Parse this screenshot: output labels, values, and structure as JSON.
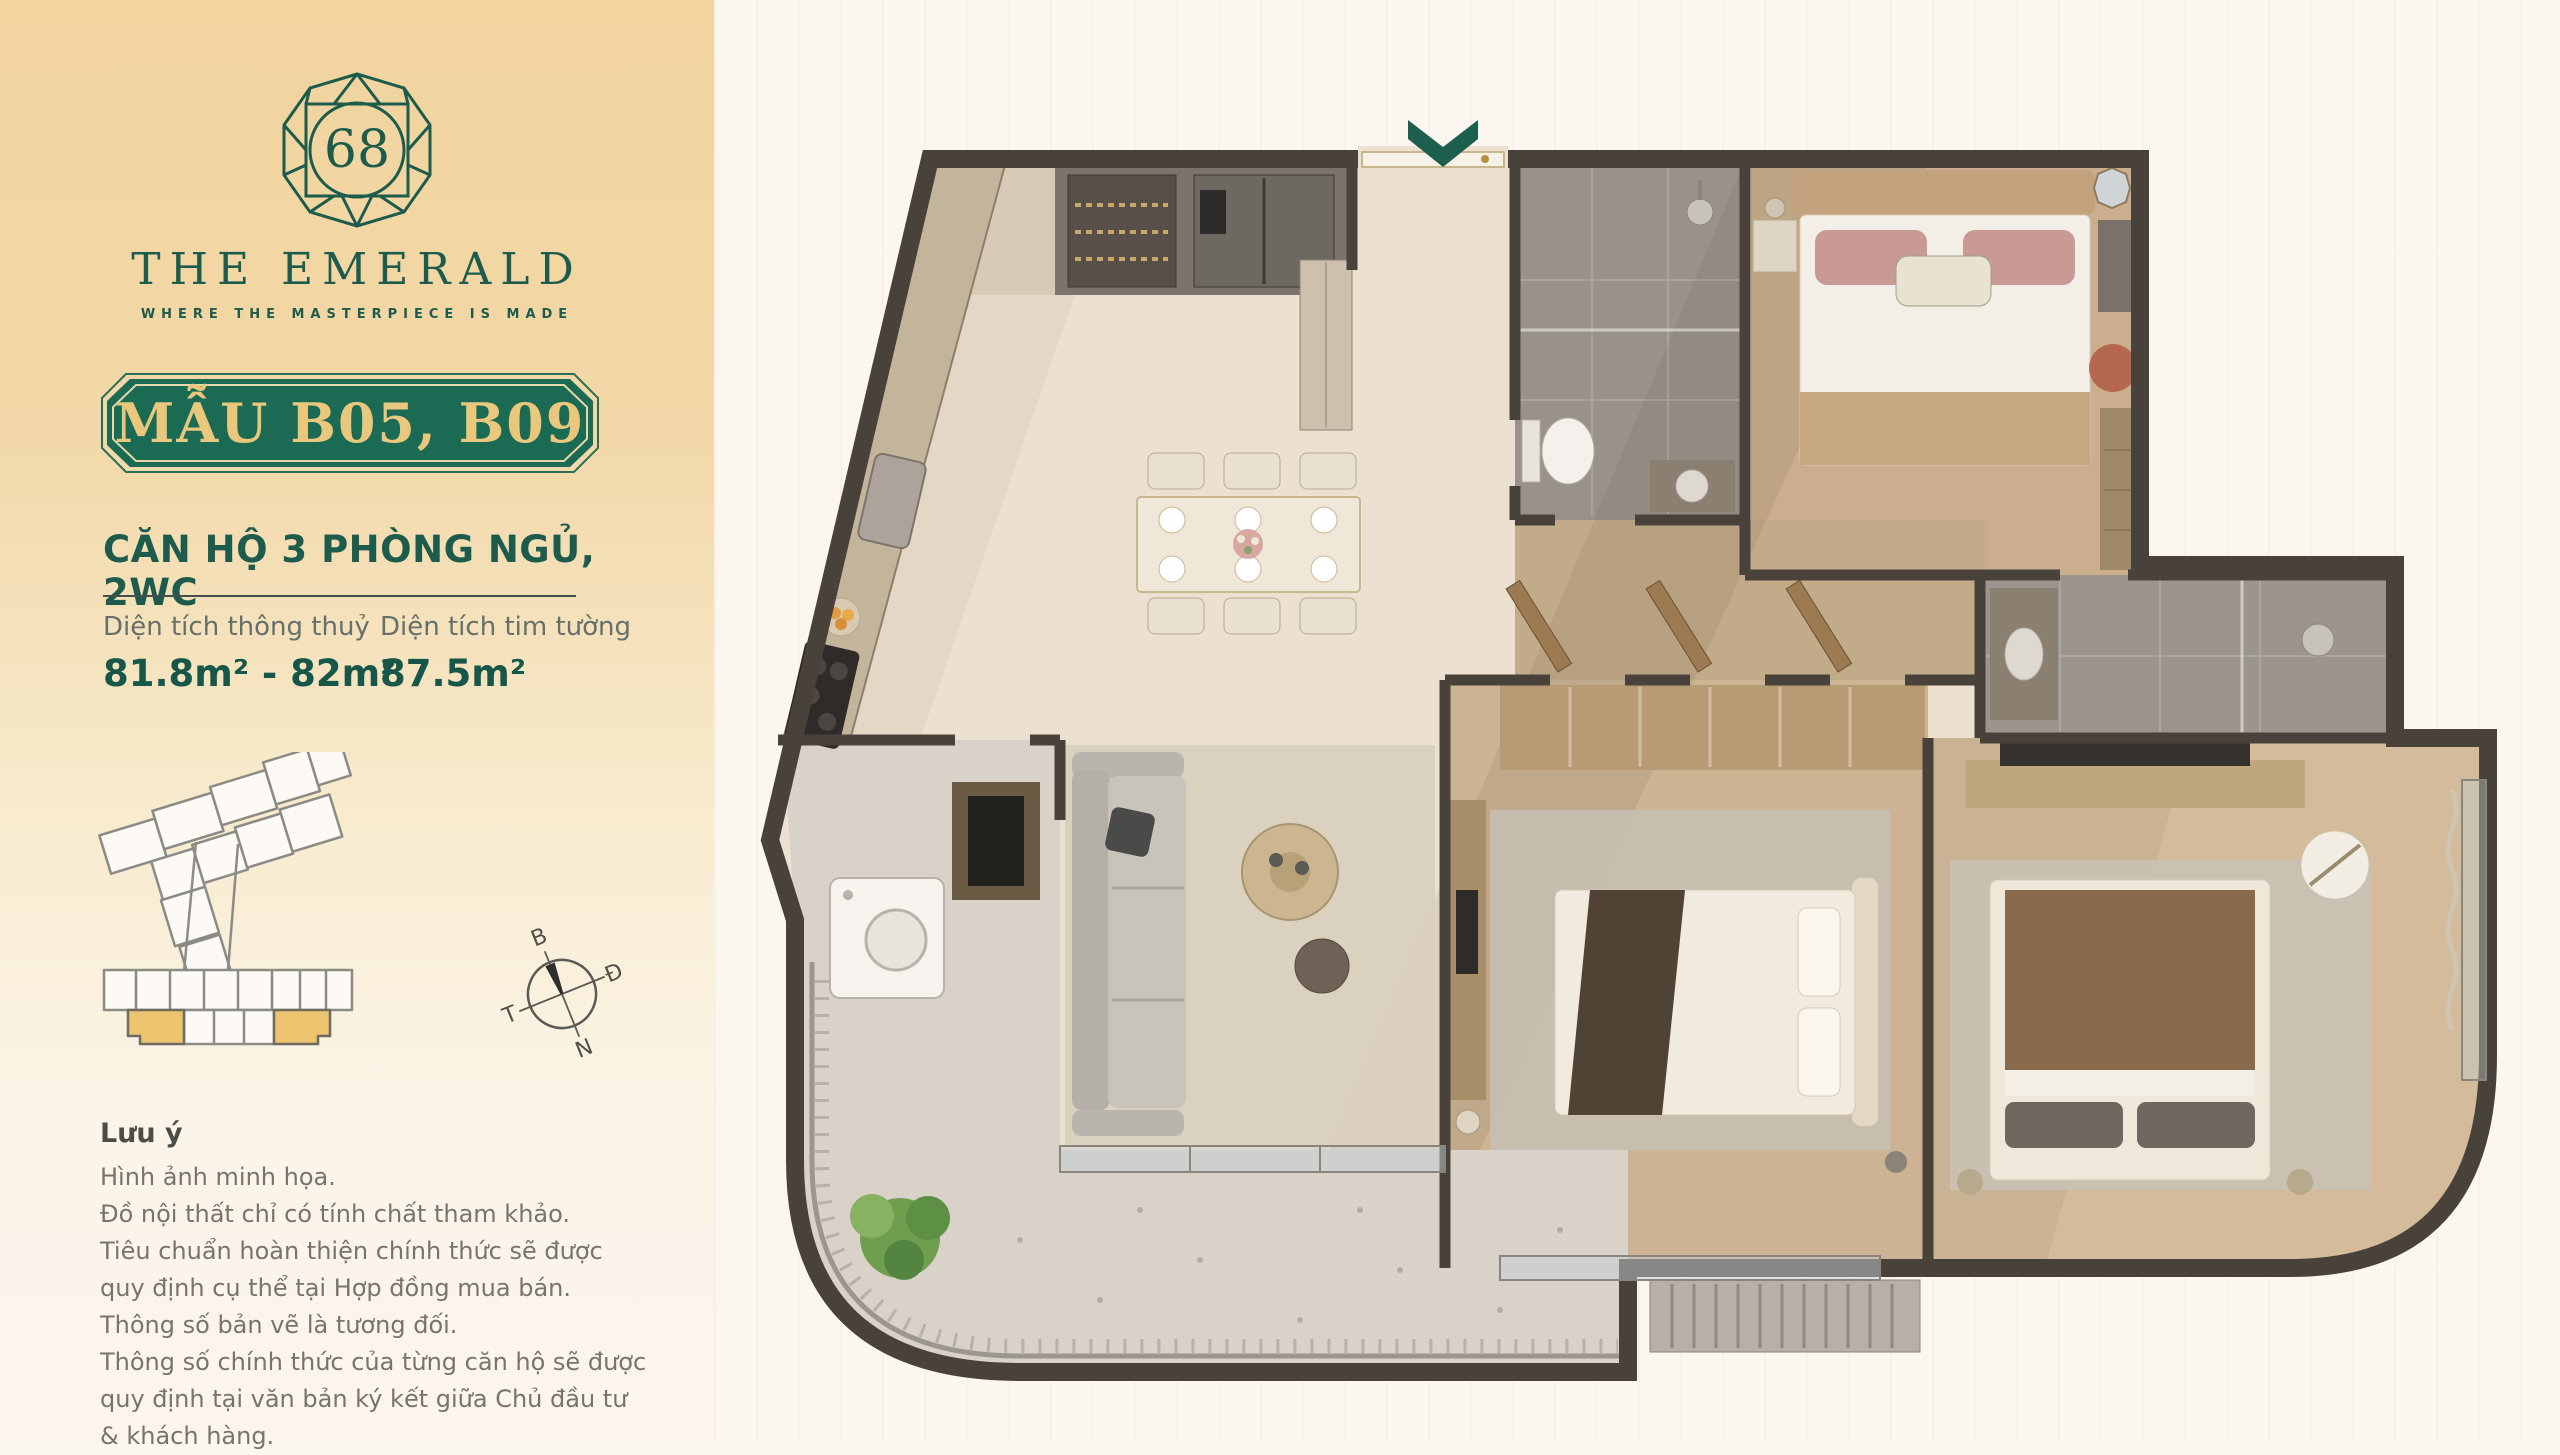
{
  "brand": {
    "logo_number": "68",
    "name": "THE EMERALD",
    "tagline": "WHERE THE MASTERPIECE IS MADE"
  },
  "unit": {
    "model_badge": "MẪU B05, B09",
    "title": "CĂN HỘ 3 PHÒNG NGỦ, 2WC"
  },
  "areas": {
    "net": {
      "label": "Diện tích thông thuỷ",
      "value": "81.8m² - 82m²"
    },
    "gross": {
      "label": "Diện tích tim tường",
      "value": "87.5m²"
    }
  },
  "compass": {
    "north": "B",
    "east": "Đ",
    "south": "N",
    "west": "T"
  },
  "notes": {
    "heading": "Lưu ý",
    "lines": [
      "Hình ảnh minh họa.",
      "Đồ nội thất chỉ có tính chất tham khảo.",
      "Tiêu chuẩn hoàn thiện chính thức sẽ được quy định cụ thể tại Hợp đồng mua bán.",
      "Thông số bản vẽ là tương đối.",
      "Thông số chính thức của từng căn hộ sẽ được quy định tại văn bản ký kết giữa Chủ đầu tư & khách hàng."
    ]
  },
  "colors": {
    "brand_green": "#1d5c4c",
    "badge_green": "#1a6a54",
    "badge_gold_text": "#e9c77c",
    "sidebar_gold": "#f1d49e",
    "highlighted_units": "#ecc46f",
    "plan_wall": "#49423b",
    "entrance_arrow": "#1d5f4e",
    "background": "#fbf6f0"
  }
}
